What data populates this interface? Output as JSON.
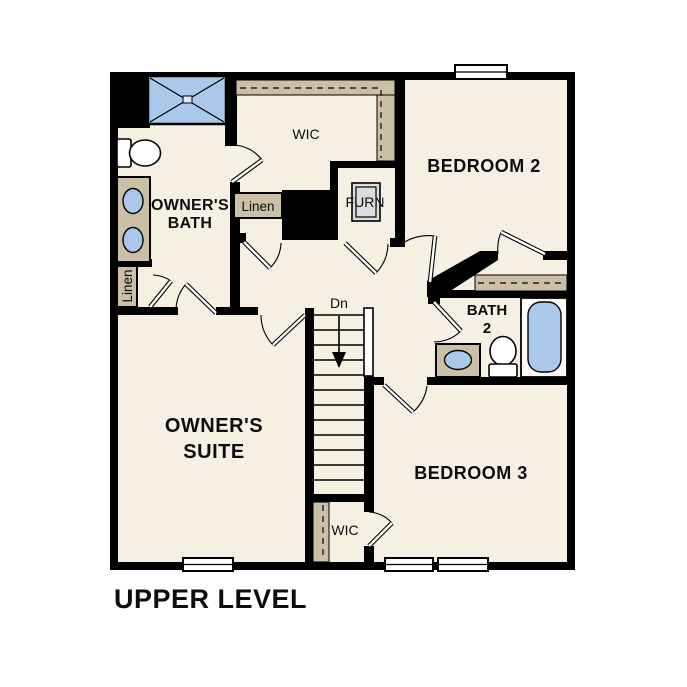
{
  "title": "UPPER LEVEL",
  "rooms": {
    "owners_suite": {
      "line1": "OWNER'S",
      "line2": "SUITE"
    },
    "owners_bath": {
      "line1": "OWNER'S",
      "line2": "BATH"
    },
    "bedroom_2": "BEDROOM 2",
    "bedroom_3": "BEDROOM 3",
    "bath_2": {
      "line1": "BATH",
      "line2": "2"
    },
    "wic_upper": "WIC",
    "wic_lower": "WIC",
    "linen_bath": "Linen",
    "linen_hall": "Linen",
    "furnace": "FURN",
    "stair_direction": "Dn"
  },
  "colors": {
    "wall": "#000000",
    "floor": "#f6f0e2",
    "closet_tan": "#cbbfa6",
    "fixture_blue": "#a9c8ea",
    "furnace_gray": "#dcdcdc"
  }
}
